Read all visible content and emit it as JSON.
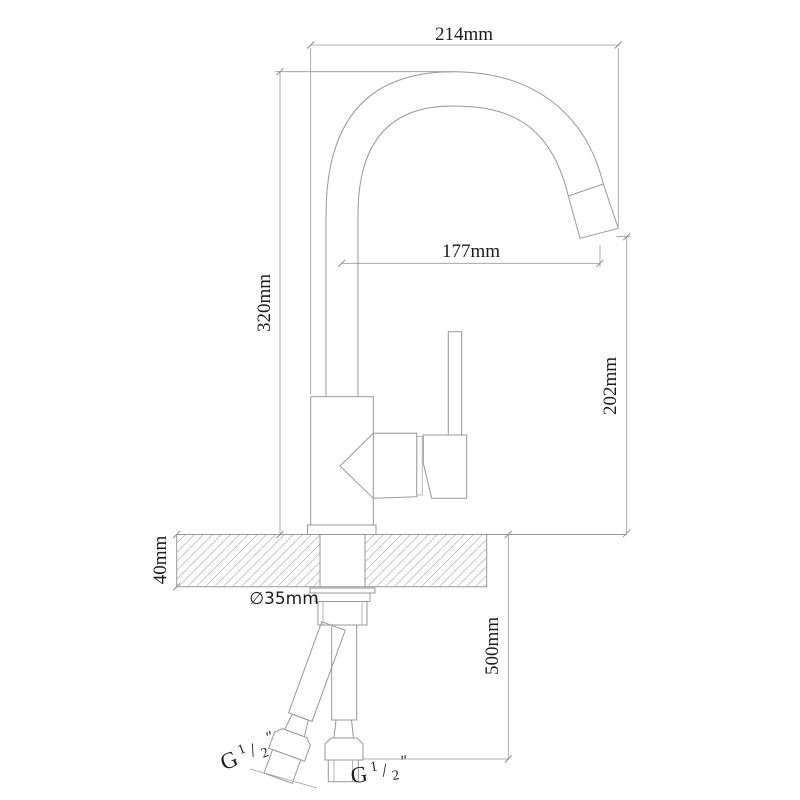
{
  "drawing": {
    "subject": "single-lever kitchen mixer tap — side elevation with installation dimensions",
    "background": "#ffffff",
    "line_color": "#98989c",
    "text_color": "#1c1c1c",
    "dimensions": {
      "overall_width": {
        "label": "214mm",
        "value_mm": 214
      },
      "spout_height": {
        "label": "320mm",
        "value_mm": 320
      },
      "spout_reach": {
        "label": "177mm",
        "value_mm": 177
      },
      "outlet_height": {
        "label": "202mm",
        "value_mm": 202
      },
      "counter_thickness": {
        "label": "40mm",
        "value_mm": 40
      },
      "hole_diameter": {
        "label": "∅35mm",
        "value_mm": 35
      },
      "hose_length": {
        "label": "500mm",
        "value_mm": 500
      },
      "thread_left": {
        "prefix": "G",
        "numerator": "1",
        "slash": "/",
        "denominator": "2",
        "unit": "″"
      },
      "thread_right": {
        "prefix": "G",
        "numerator": "1",
        "slash": "/",
        "denominator": "2",
        "unit": "″"
      }
    }
  }
}
